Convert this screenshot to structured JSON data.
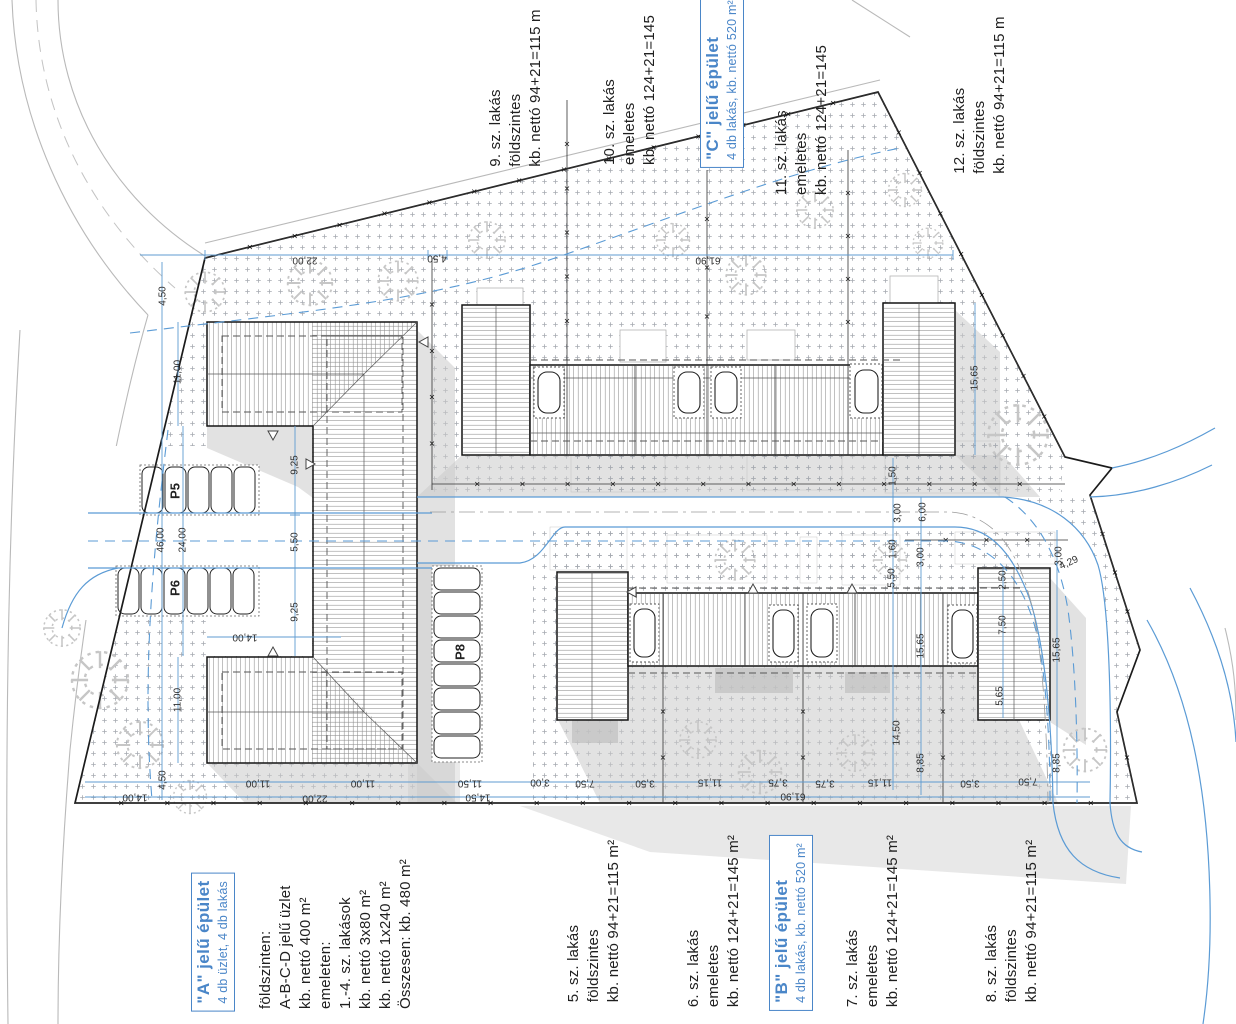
{
  "page": {
    "background": "#ffffff"
  },
  "colors": {
    "accent_blue": "#4a86c8",
    "dim_blue": "#5f9bd0",
    "line_black": "#141414",
    "shadow_gray": "#cbcbcb",
    "tree_gray": "#c6c6c6"
  },
  "blocks": {
    "a": {
      "title": "\"A\" jelű épület",
      "subtitle": "4 db üzlet, 4 db lakás",
      "details": [
        "földszinten:",
        "A-B-C-D jelű üzlet",
        "kb. nettó 400 m²",
        "emeleten:",
        "1.-4. sz. lakások",
        "kb. nettó 3x80 m²",
        "kb. nettó 1x240 m²",
        "Összesen: kb. 480 m²"
      ]
    },
    "b": {
      "title": "\"B\" jelű épület",
      "subtitle": "4 db lakás, kb. nettó 520 m²"
    },
    "c": {
      "title": "\"C\" jelű épület",
      "subtitle": "4 db lakás, kb. nettó 520 m²"
    }
  },
  "units": {
    "u5": {
      "name": "5. sz. lakás",
      "type": "földszintes",
      "area": "kb. nettó 94+21=115 m²"
    },
    "u6": {
      "name": "6. sz. lakás",
      "type": "emeletes",
      "area": "kb. nettó 124+21=145 m²"
    },
    "u7": {
      "name": "7. sz. lakás",
      "type": "emeletes",
      "area": "kb. nettó 124+21=145 m²"
    },
    "u8": {
      "name": "8. sz. lakás",
      "type": "földszintes",
      "area": "kb. nettó 94+21=115 m²"
    },
    "u9": {
      "name": "9. sz. lakás",
      "type": "földszintes",
      "area": "kb. nettó 94+21=115 m"
    },
    "u10": {
      "name": "10. sz. lakás",
      "type": "emeletes",
      "area": "kb. nettó 124+21=145"
    },
    "u11": {
      "name": "11. sz. lakás",
      "type": "emeletes",
      "area": "kb. nettó 124+21=145"
    },
    "u12": {
      "name": "12. sz. lakás",
      "type": "földszintes",
      "area": "kb. nettó 94+21=115 m"
    }
  },
  "parking": {
    "p5": "P5",
    "p6": "P6",
    "p8": "P8"
  },
  "dims": {
    "d2200": "22,00",
    "d0450": "4,50",
    "d6190": "61,90",
    "d1100": "11,00",
    "d4600": "46,00",
    "d2400": "24,00",
    "d0925": "9,25",
    "d0550": "5,50",
    "d1400": "14,00",
    "d1150": "11,50",
    "d1450": "14,50",
    "d0300": "3,00",
    "d0600": "6,00",
    "d0150": "1,50",
    "d0160": "1,60",
    "d0250": "2,50",
    "d0750": "7,50",
    "d0350": "3,50",
    "d0375": "3,75",
    "d0885": "8,85",
    "d1115": "11,15",
    "d1565": "15,65",
    "d0429": "4,29",
    "d0565": "5,65"
  }
}
